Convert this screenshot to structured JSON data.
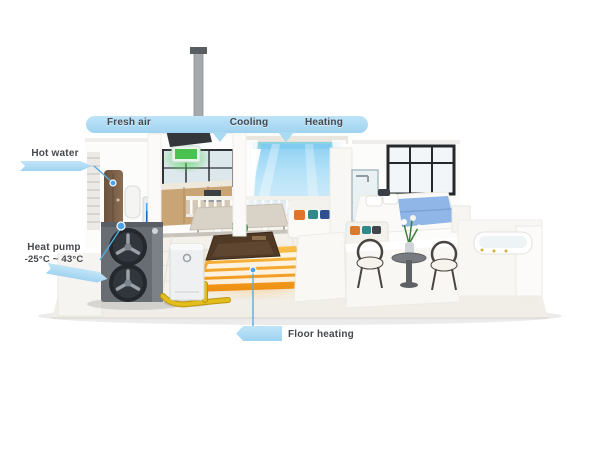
{
  "scene": {
    "description": "Cutaway 3D house diagram of an air-source heat pump system with labeled functions",
    "background": "#ffffff"
  },
  "labels": {
    "fresh_air": "Fresh air",
    "cooling": "Cooling",
    "heating": "Heating",
    "hot_water": "Hot water",
    "heat_pump_line1": "Heat pump",
    "heat_pump_line2": "-25°C ~ 43°C",
    "floor_heating": "Floor heating"
  },
  "colors": {
    "label_blue": "#a9daf3",
    "label_text": "#45484d",
    "pipe_yellow": "#e3bd1d",
    "rug_glow_orange": "#ee8d10",
    "air_curtain_blue": "#7ccaf2",
    "fresh_air_green": "#4bc152",
    "heat_pump_gray": "#676d73",
    "bed_blanket_blue": "#8fb6e6"
  }
}
